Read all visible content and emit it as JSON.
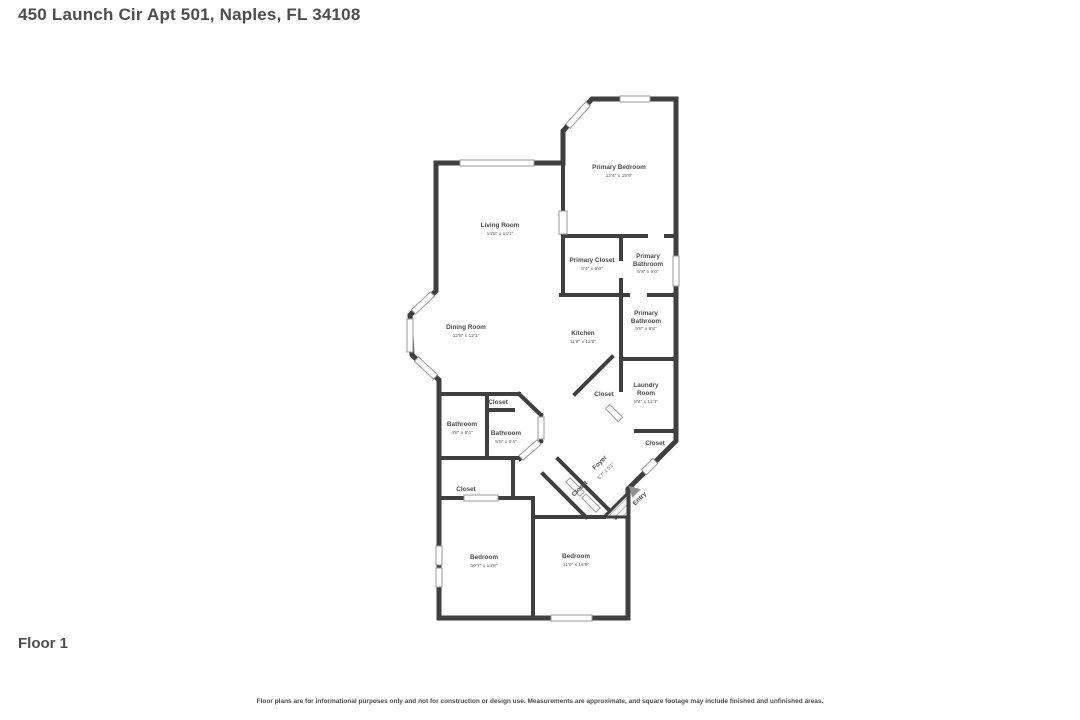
{
  "page": {
    "title": "450 Launch Cir Apt 501, Naples, FL 34108",
    "floor_label": "Floor 1",
    "disclaimer": "Floor plans are for informational purposes only and not for construction or design use. Measurements are approximate, and square footage may include finished and unfinished areas."
  },
  "colors": {
    "wall": "#3f3f3f",
    "room_fill": "#f4f4f4",
    "text": "#4a4a4a",
    "window_stroke": "#9a9a9a",
    "entry_arrow": "#909090"
  },
  "rooms": {
    "primary_bedroom": {
      "name": "Primary Bedroom",
      "dims": "12'4\" x 15'9\""
    },
    "living_room": {
      "name": "Living Room",
      "dims": "14'5\" x 14'1\""
    },
    "primary_closet": {
      "name": "Primary Closet",
      "dims": "6'4\" x 6'0\""
    },
    "primary_bathroom_upper": {
      "line1": "Primary",
      "line2": "Bathroom",
      "dims": "5'8\" x 6'0\""
    },
    "primary_bathroom_lower": {
      "line1": "Primary",
      "line2": "Bathroom",
      "dims": "5'8\" x 6'8\""
    },
    "dining_room": {
      "name": "Dining Room",
      "dims": "12'8\" x 12'1\""
    },
    "kitchen": {
      "name": "Kitchen",
      "dims": "11'8\" x 12'6\""
    },
    "laundry_room": {
      "line1": "Laundry",
      "line2": "Room",
      "dims": "8'4\" x 11'3\""
    },
    "closet_kitchen": {
      "name": "Closet"
    },
    "closet_laundry": {
      "name": "Closet"
    },
    "closet_bath_top": {
      "name": "Closet"
    },
    "closet_hall": {
      "name": "Closet"
    },
    "closet_corridor": {
      "name": "Closet"
    },
    "bathroom_left": {
      "name": "Bathroom",
      "dims": "4'8\" x 8'4\""
    },
    "bathroom_right": {
      "name": "Bathroom",
      "dims": "5'5\" x 6'4\""
    },
    "foyer": {
      "name": "Foyer",
      "dims": "6'7\" x 5'1\""
    },
    "entry": {
      "name": "Entry"
    },
    "bedroom_left": {
      "name": "Bedroom",
      "dims": "10'7\" x 13'9\""
    },
    "bedroom_right": {
      "name": "Bedroom",
      "dims": "11'0\" x 16'9\""
    }
  }
}
